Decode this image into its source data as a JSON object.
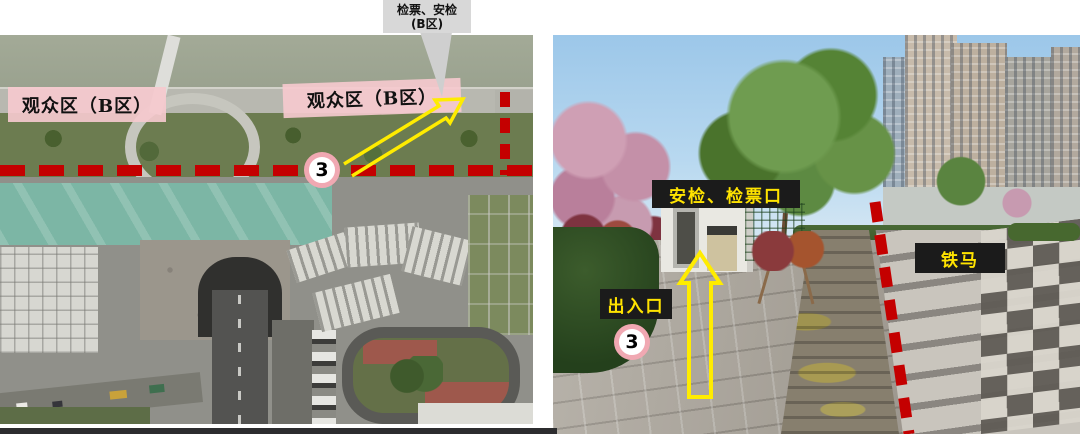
{
  "page": {
    "callout": {
      "line1": "检票、安检",
      "line2": "(B区)"
    },
    "aerial_map": {
      "zone_label_left": "观众区（B区）",
      "zone_label_right": "观众区（B区）",
      "gate_number": "3"
    },
    "street_photo": {
      "checkpoint_label": "安检、检票口",
      "entrance_label": "出入口",
      "barrier_label": "铁马",
      "gate_number": "3"
    },
    "colors": {
      "annotation_red": "#c40000",
      "annotation_yellow": "#ffec00",
      "zone_pink": "#f5c9ce",
      "highlight_teal": "#6ed2b9",
      "label_black_bg": "#1b1b1b",
      "callout_gray": "#d8d8d8",
      "badge_ring_pink": "#f0a8b2"
    }
  }
}
